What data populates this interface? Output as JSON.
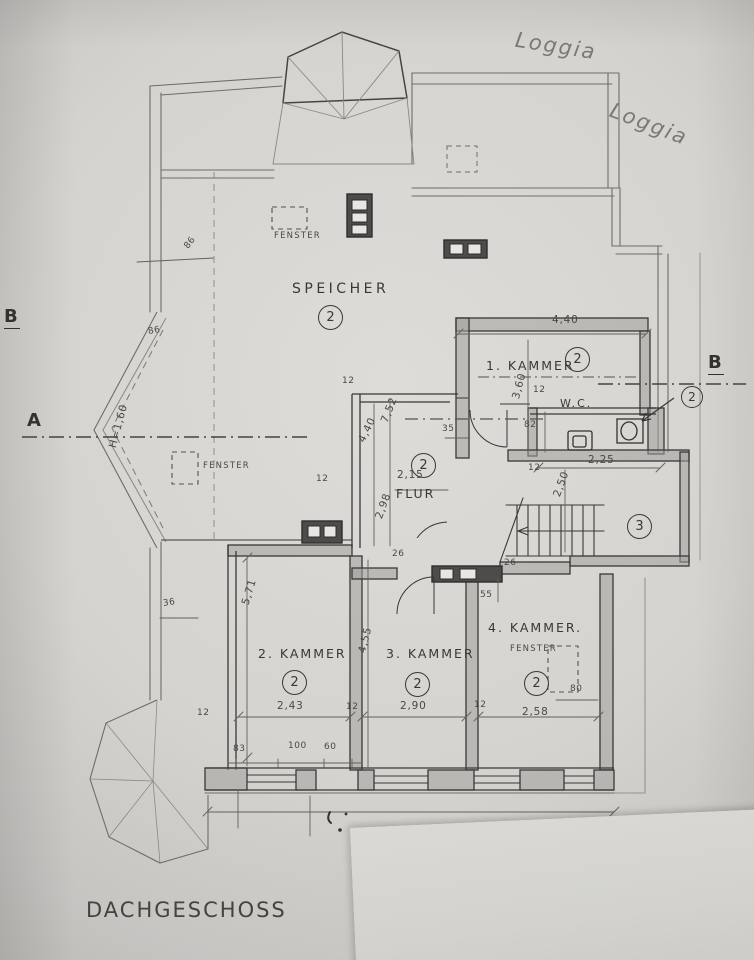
{
  "title": {
    "text": "DACHGESCHOSS"
  },
  "handwritten": {
    "loggia_top": "Loggia",
    "loggia_right": "Loggia"
  },
  "section_markers": {
    "a_left": "A",
    "b_left": "B",
    "b_right": "B",
    "detail_bubble": "2"
  },
  "rooms": {
    "speicher": {
      "name": "SPEICHER",
      "zone": "2"
    },
    "kammer1": {
      "name": "1. KAMMER",
      "zone": "2"
    },
    "wc": {
      "name": "W.C.",
      "zone": "2"
    },
    "flur": {
      "name": "FLUR",
      "zone": "2"
    },
    "stairwell": {
      "zone": "3"
    },
    "kammer2": {
      "name": "2. KAMMER",
      "zone": "2"
    },
    "kammer3": {
      "name": "3. KAMMER",
      "zone": "2"
    },
    "kammer4": {
      "name": "4. KAMMER.",
      "zone": "2"
    }
  },
  "window_label": "FENSTER",
  "dims": {
    "d12": "12",
    "d26": "26",
    "d35": "35",
    "d36": "36",
    "d55": "55",
    "d60": "60",
    "d80": "80",
    "d82": "82",
    "d83": "83",
    "d86": "86",
    "d100": "100",
    "d215": "2,15",
    "d225": "2,25",
    "d243": "2,43",
    "d250": "2,50",
    "d258": "2,58",
    "d290": "2,90",
    "d298": "2,98",
    "d360": "3,60",
    "d440": "4,40",
    "d455": "4,55",
    "d571": "5,71",
    "d752": "7,52",
    "h160": "H=1,60"
  },
  "colors": {
    "pencil": "#6f6d69",
    "ink": "#3a3836",
    "wall_fill": "#a3a19d",
    "chimney": "#4e4c4a"
  }
}
